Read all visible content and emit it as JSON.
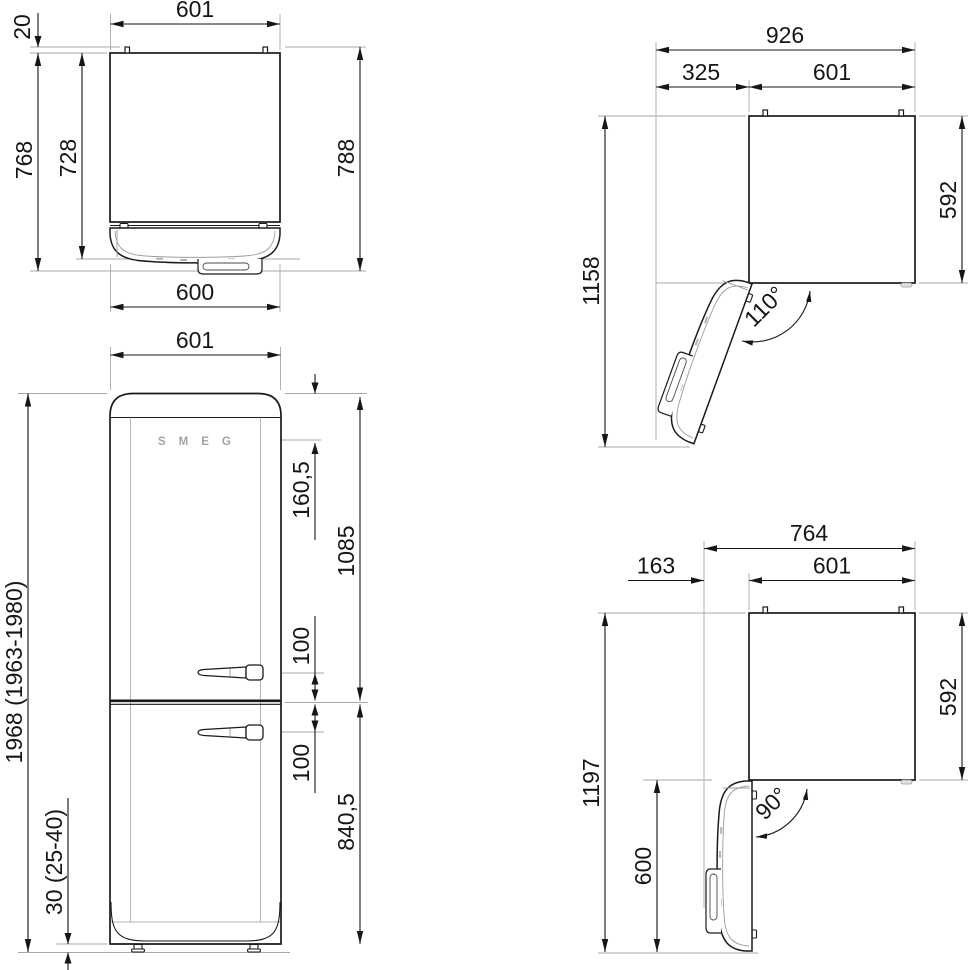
{
  "drawing_title": "Refrigerator dimension drawing",
  "brand": "SMEG",
  "palette": {
    "line": "#161616",
    "extension": "#a8a8a8",
    "logo_gray": "#a3a3a3",
    "background": "#ffffff"
  },
  "views": {
    "top_closed": {
      "width_top": "601",
      "hinge_offset": "20",
      "depth_with_door": "768",
      "depth_cabinet": "728",
      "depth_total": "788",
      "door_width": "600"
    },
    "open_110": {
      "total_width": "926",
      "clearance": "325",
      "width": "601",
      "depth": "592",
      "total_depth": "1158",
      "angle": "110°"
    },
    "front": {
      "width": "601",
      "logo": "SMEG",
      "logo_from_top": "160,5",
      "upper_door_height": "1085",
      "handle_gap_upper": "100",
      "handle_gap_lower": "100",
      "lower_door_height": "840,5",
      "total_height": "1968 (1963-1980)",
      "feet_height": "30 (25-40)"
    },
    "open_90": {
      "total_width": "764",
      "clearance": "163",
      "width": "601",
      "depth": "592",
      "total_depth": "1197",
      "door_length": "600",
      "angle": "90°"
    }
  }
}
